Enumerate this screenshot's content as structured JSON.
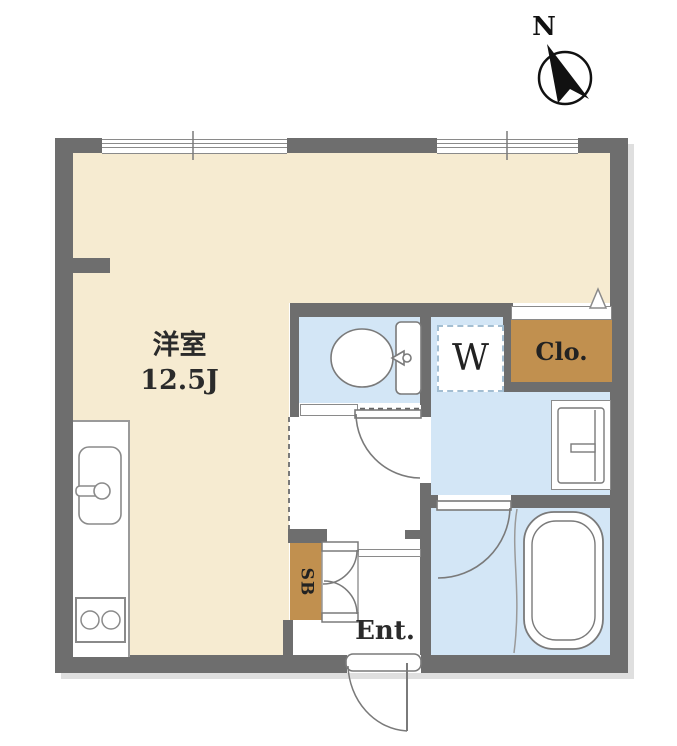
{
  "compass": {
    "label": "N"
  },
  "rooms": {
    "main_room": {
      "name": "洋室",
      "size": "12.5J"
    },
    "washer_space": {
      "label": "W"
    },
    "closet": {
      "label": "Clo."
    },
    "shoe_box": {
      "label": "SB"
    },
    "entrance": {
      "label": "Ent."
    }
  },
  "colors": {
    "floor_main": "#f6ebd1",
    "floor_wet": "#d3e6f6",
    "floor_hall": "#ffffff",
    "wall": "#6e6e6e",
    "storage": "#c1904f",
    "outline": "#7a7a7a",
    "washer_dash": "#a3bed2"
  }
}
